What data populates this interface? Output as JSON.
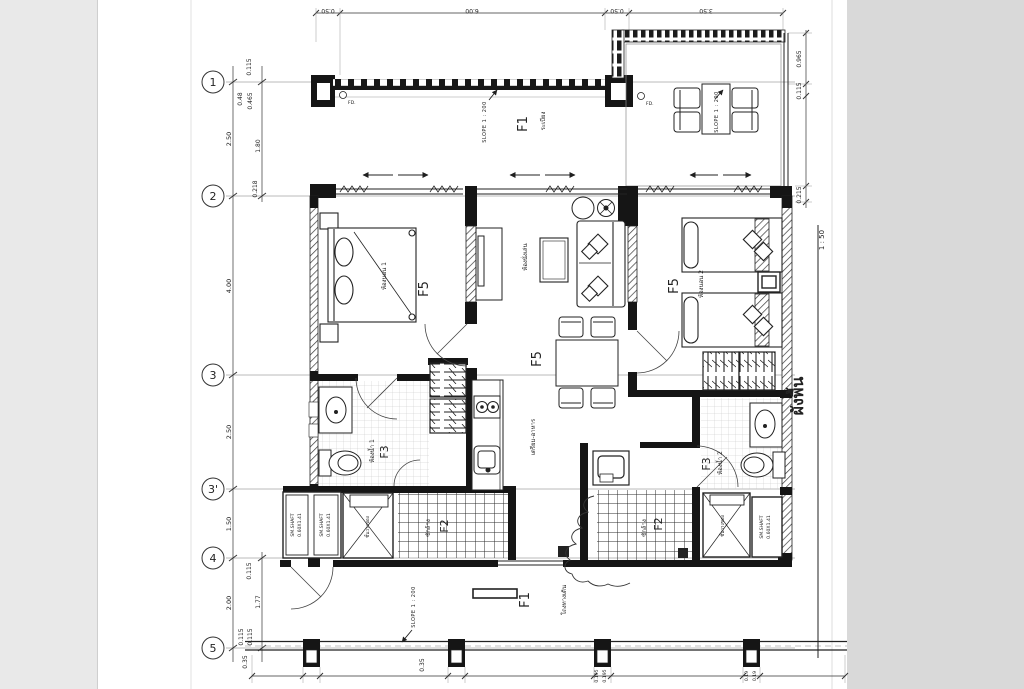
{
  "title_block": {
    "title": "ผังพื้น",
    "scale": "1 : 50"
  },
  "grid": {
    "bubbles": [
      "1",
      "2",
      "3",
      "3'",
      "4",
      "5"
    ]
  },
  "dims": {
    "top": [
      "0.50",
      "6.00",
      "0.50",
      "3.50"
    ],
    "left_outer": [
      "2.50",
      "4.00",
      "2.50",
      "1.50",
      "2.00"
    ],
    "left_inner": [
      "0.115",
      "0.48",
      "0.465",
      "1.80",
      "0.218",
      "0.115",
      "1.77",
      "0.115",
      "0.115",
      "0.35"
    ],
    "right": [
      "0.965",
      "0.115",
      "0.215"
    ],
    "bottom": [
      "0.35",
      "0.195",
      "0.195",
      "0.19",
      "0.19"
    ]
  },
  "rooms": {
    "balcony": {
      "code": "F1",
      "name": "ระเบียง"
    },
    "bedroom1": {
      "code": "F5",
      "name": "ห้องนอน 1"
    },
    "living": {
      "code": "F5",
      "name": "ห้องนั่งเล่น"
    },
    "dining": {
      "code": "F5"
    },
    "bedroom2": {
      "code": "F5",
      "name": "ห้องนอน 2"
    },
    "bath1": {
      "code": "F3",
      "name": "ห้องน้ำ 1"
    },
    "bath2": {
      "code": "F3",
      "name": "ห้องน้ำ 2"
    },
    "laundry_left": {
      "code": "F2",
      "name": "ซักล้าง"
    },
    "laundry_right": {
      "code": "F2",
      "name": "ซักล้าง"
    },
    "corridor": {
      "code": "F1",
      "name": "โถงทางเดิน"
    },
    "kitchen": {
      "name": "เตรียม-อาหาร"
    },
    "shelf_left": {
      "name": "ชั้นวางของ"
    },
    "shelf_right": {
      "name": "ชั้นวางของ"
    }
  },
  "annotations": {
    "slope": "SLOPE 1 : 200",
    "shaft_line1": "SM.SHAFT",
    "shaft_line2": "0.60X1.41",
    "fd": "FD."
  }
}
